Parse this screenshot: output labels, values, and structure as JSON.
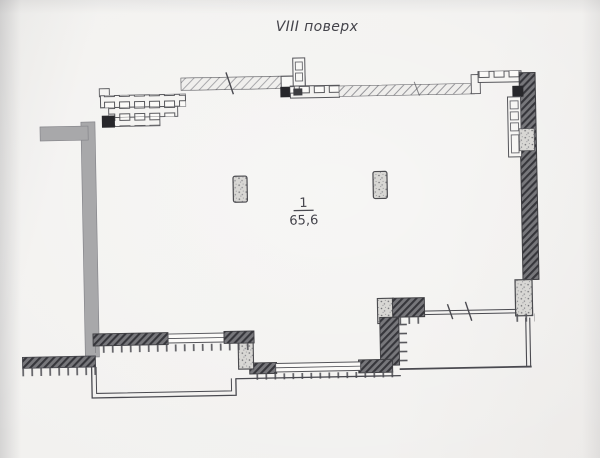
{
  "header": {
    "floor_title": "VIII поверх"
  },
  "room_label": {
    "number": "1",
    "area": "65,6"
  },
  "plan": {
    "type": "apartment-floor-plan",
    "features": [
      "stepped-top-exterior-wall-with-window-blocks",
      "dark-hatched-right-exterior-wall",
      "interior-shaft-block-top-right",
      "two-freestanding-columns",
      "bottom-left-balcony",
      "bottom-right-balcony-with-railing",
      "gray-party-wall-left"
    ]
  },
  "colors": {
    "paper": "#f1f0ee",
    "ink": "#4a4a50",
    "wall_dark_hatch": "#77777b",
    "hatch_stripe": "#36363b",
    "party_wall_gray": "#a8a8aa",
    "pier_stipple": "#d8d7d4",
    "solid_column": "#27272b",
    "window_fill": "#fbfaf8"
  }
}
